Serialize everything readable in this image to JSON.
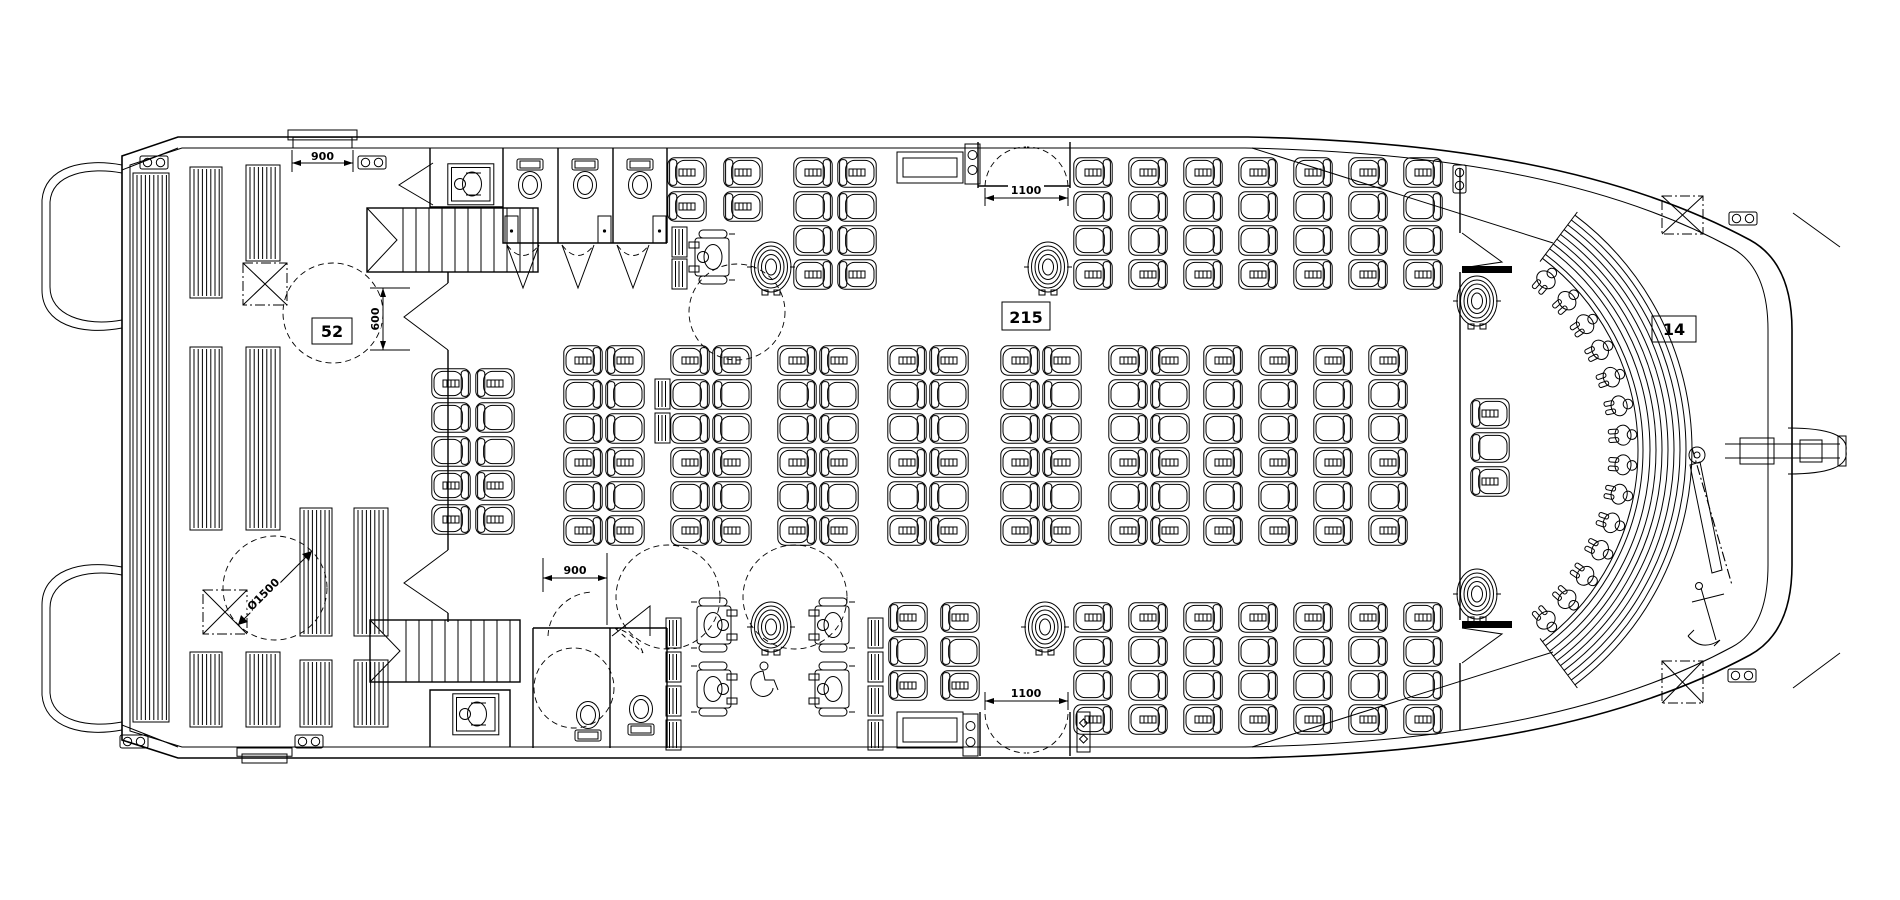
{
  "drawing": {
    "type": "vessel deck plan",
    "description": "Catamaran ferry main deck general arrangement with seating"
  },
  "zones": {
    "aft_deck": {
      "capacity": "52",
      "label": "aft open deck bench seating"
    },
    "main_cabin": {
      "capacity": "215",
      "label": "main cabin saloon seating"
    },
    "bow_deck": {
      "capacity": "14",
      "label": "bow amphitheater seating"
    }
  },
  "dimensions": [
    {
      "text": "900",
      "label": "aft side gate clear width"
    },
    {
      "text": "600",
      "label": "aft deck passage width"
    },
    {
      "text": "Ø1500",
      "label": "wheelchair turning circle diameter"
    },
    {
      "text": "900",
      "label": "lower lobby door clear width"
    },
    {
      "text": "1100",
      "label": "upper cabin entrance door clear width"
    },
    {
      "text": "1100",
      "label": "lower cabin entrance door clear width"
    }
  ],
  "plan": {
    "seat_groups": [
      {
        "name": "upper-port-singles",
        "cols": [
          667,
          723
        ],
        "rows": [
          157,
          191
        ],
        "facing": [
          "right",
          "right"
        ]
      },
      {
        "name": "upper-port-pairs",
        "cols": [
          793,
          837
        ],
        "rows": [
          157,
          191,
          225,
          259
        ],
        "facing": [
          "left",
          "right"
        ]
      },
      {
        "name": "upper-starboard-block",
        "cols": [
          1073,
          1128,
          1183,
          1238,
          1293,
          1348,
          1403
        ],
        "rows": [
          157,
          191,
          225,
          259
        ],
        "facing": "left"
      },
      {
        "name": "centre-aft-pair",
        "cols": [
          431,
          475
        ],
        "rows": [
          368,
          402,
          436,
          470,
          504
        ],
        "facing": [
          "left",
          "right"
        ]
      },
      {
        "name": "centre-pair-1",
        "cols": [
          563,
          605
        ],
        "rows": [
          345,
          379,
          413,
          447,
          481,
          515
        ],
        "facing": [
          "left",
          "right"
        ]
      },
      {
        "name": "centre-pair-2",
        "cols": [
          670,
          712
        ],
        "rows": [
          345,
          379,
          413,
          447,
          481,
          515
        ],
        "facing": [
          "left",
          "right"
        ]
      },
      {
        "name": "centre-pair-3",
        "cols": [
          777,
          819
        ],
        "rows": [
          345,
          379,
          413,
          447,
          481,
          515
        ],
        "facing": [
          "left",
          "right"
        ]
      },
      {
        "name": "centre-pair-4",
        "cols": [
          887,
          929
        ],
        "rows": [
          345,
          379,
          413,
          447,
          481,
          515
        ],
        "facing": [
          "left",
          "right"
        ]
      },
      {
        "name": "centre-pair-5",
        "cols": [
          1000,
          1042
        ],
        "rows": [
          345,
          379,
          413,
          447,
          481,
          515
        ],
        "facing": [
          "left",
          "right"
        ]
      },
      {
        "name": "centre-pair-6",
        "cols": [
          1108,
          1150
        ],
        "rows": [
          345,
          379,
          413,
          447,
          481,
          515
        ],
        "facing": [
          "left",
          "right"
        ]
      },
      {
        "name": "centre-singles",
        "cols": [
          1203,
          1258,
          1313,
          1368
        ],
        "rows": [
          345,
          379,
          413,
          447,
          481,
          515
        ],
        "facing": "left"
      },
      {
        "name": "lower-port-block",
        "cols": [
          888,
          940
        ],
        "rows": [
          602,
          636,
          670
        ],
        "facing": "right"
      },
      {
        "name": "lower-mid-col",
        "cols": [
          1073
        ],
        "rows": [
          602,
          636,
          670,
          704
        ],
        "facing": "left"
      },
      {
        "name": "lower-starboard-block",
        "cols": [
          1128,
          1183,
          1238,
          1293,
          1348,
          1403
        ],
        "rows": [
          602,
          636,
          670,
          704
        ],
        "facing": "left"
      },
      {
        "name": "bow-deck-col",
        "cols": [
          1470
        ],
        "rows": [
          398,
          432,
          466
        ],
        "facing": "right"
      }
    ],
    "benches": [
      [
        133,
        173,
        36,
        549
      ],
      [
        190,
        167,
        32,
        131
      ],
      [
        246,
        165,
        34,
        96
      ],
      [
        190,
        347,
        32,
        183
      ],
      [
        246,
        347,
        34,
        183
      ],
      [
        190,
        652,
        32,
        75
      ],
      [
        246,
        652,
        34,
        75
      ],
      [
        300,
        508,
        32,
        128
      ],
      [
        354,
        508,
        34,
        128
      ],
      [
        300,
        660,
        32,
        67
      ],
      [
        354,
        660,
        34,
        67
      ]
    ],
    "tipup_seats": [
      [
        672,
        227
      ],
      [
        672,
        259
      ],
      [
        655,
        379
      ],
      [
        655,
        413
      ],
      [
        666,
        618
      ],
      [
        666,
        652
      ],
      [
        666,
        686
      ],
      [
        666,
        720
      ],
      [
        868,
        618
      ],
      [
        868,
        652
      ],
      [
        868,
        686
      ],
      [
        868,
        720
      ]
    ],
    "hatches": [
      [
        243,
        263,
        44,
        42
      ],
      [
        203,
        590,
        44,
        44
      ],
      [
        1662,
        196,
        41,
        38
      ],
      [
        1662,
        661,
        41,
        42
      ]
    ],
    "cleats": [
      [
        140,
        156,
        0
      ],
      [
        358,
        156,
        0
      ],
      [
        120,
        735,
        0
      ],
      [
        295,
        735,
        0
      ],
      [
        1466,
        165,
        90
      ],
      [
        1729,
        212,
        0
      ],
      [
        1728,
        669,
        0
      ]
    ],
    "gates": [
      [
        288,
        130,
        69,
        18
      ],
      [
        237,
        748,
        55,
        15
      ]
    ],
    "stairs": [
      [
        367,
        208,
        171,
        64
      ],
      [
        370,
        620,
        150,
        62
      ]
    ],
    "turning_circles": [
      [
        333,
        313,
        50
      ],
      [
        275,
        588,
        52
      ],
      [
        737,
        312,
        48
      ],
      [
        668,
        597,
        52
      ],
      [
        795,
        597,
        52
      ],
      [
        574,
        688,
        40
      ]
    ],
    "life_rings": [
      [
        771,
        267
      ],
      [
        1048,
        267
      ],
      [
        771,
        627
      ],
      [
        1045,
        627
      ],
      [
        1477,
        301
      ],
      [
        1477,
        594
      ]
    ],
    "toilets": [
      [
        530,
        176,
        "down"
      ],
      [
        585,
        176,
        "down"
      ],
      [
        640,
        176,
        "down"
      ],
      [
        641,
        712,
        "up"
      ],
      [
        588,
        718,
        "up"
      ]
    ],
    "wheelchair_users": [
      [
        712,
        257,
        "left"
      ],
      [
        714,
        625,
        "right"
      ],
      [
        714,
        689,
        "right"
      ],
      [
        832,
        625,
        "left"
      ],
      [
        832,
        689,
        "left"
      ]
    ],
    "access_icons": [
      [
        758,
        678
      ]
    ],
    "changing_tables": [
      [
        447,
        163
      ],
      [
        452,
        693
      ]
    ],
    "bow_arena": {
      "cx": 1398,
      "cy": 450,
      "rail": [
        240,
        245
      ],
      "steps": [
        252,
        258,
        264,
        270,
        276,
        282,
        288,
        294
      ],
      "a1": -53,
      "a2": 53,
      "figures": 14,
      "fig_r": 228
    }
  }
}
